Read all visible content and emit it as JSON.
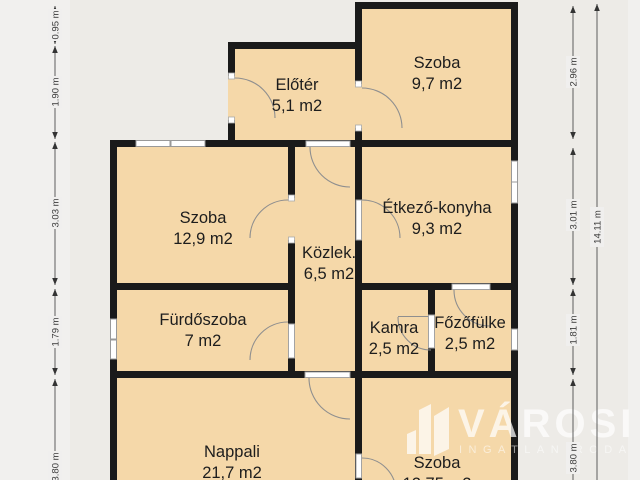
{
  "rooms": [
    {
      "name": "Előtér",
      "area": "5,1 m2"
    },
    {
      "name": "Szoba",
      "area": "9,7 m2"
    },
    {
      "name": "Szoba",
      "area": "12,9 m2"
    },
    {
      "name": "Étkező-konyha",
      "area": "9,3 m2"
    },
    {
      "name": "Közlek.",
      "area": "6,5 m2"
    },
    {
      "name": "Fürdőszoba",
      "area": "7 m2"
    },
    {
      "name": "Kamra",
      "area": "2,5 m2"
    },
    {
      "name": "Főzőfülke",
      "area": "2,5 m2"
    },
    {
      "name": "Nappali",
      "area": "21,7 m2"
    },
    {
      "name": "Szoba",
      "area": "12,75 m2"
    }
  ],
  "dimensions": {
    "left": [
      "0.95 m",
      "1.90 m",
      "3.03 m",
      "1.79 m",
      "3.80 m"
    ],
    "right_inner": [
      "2.96 m",
      "3.01 m",
      "1.81 m",
      "3.80 m"
    ],
    "right_outer": "14.11 m"
  },
  "logo": {
    "title": "VÁROSI",
    "subtitle": "INGATLANIRODA"
  },
  "colors": {
    "room_fill": "#f5d8a9",
    "wall": "#1a1a1a",
    "background": "#f1f0ee",
    "plan_background": "#edebe7",
    "logo": "#ffffff",
    "dimension_text": "#3a3a3a"
  }
}
